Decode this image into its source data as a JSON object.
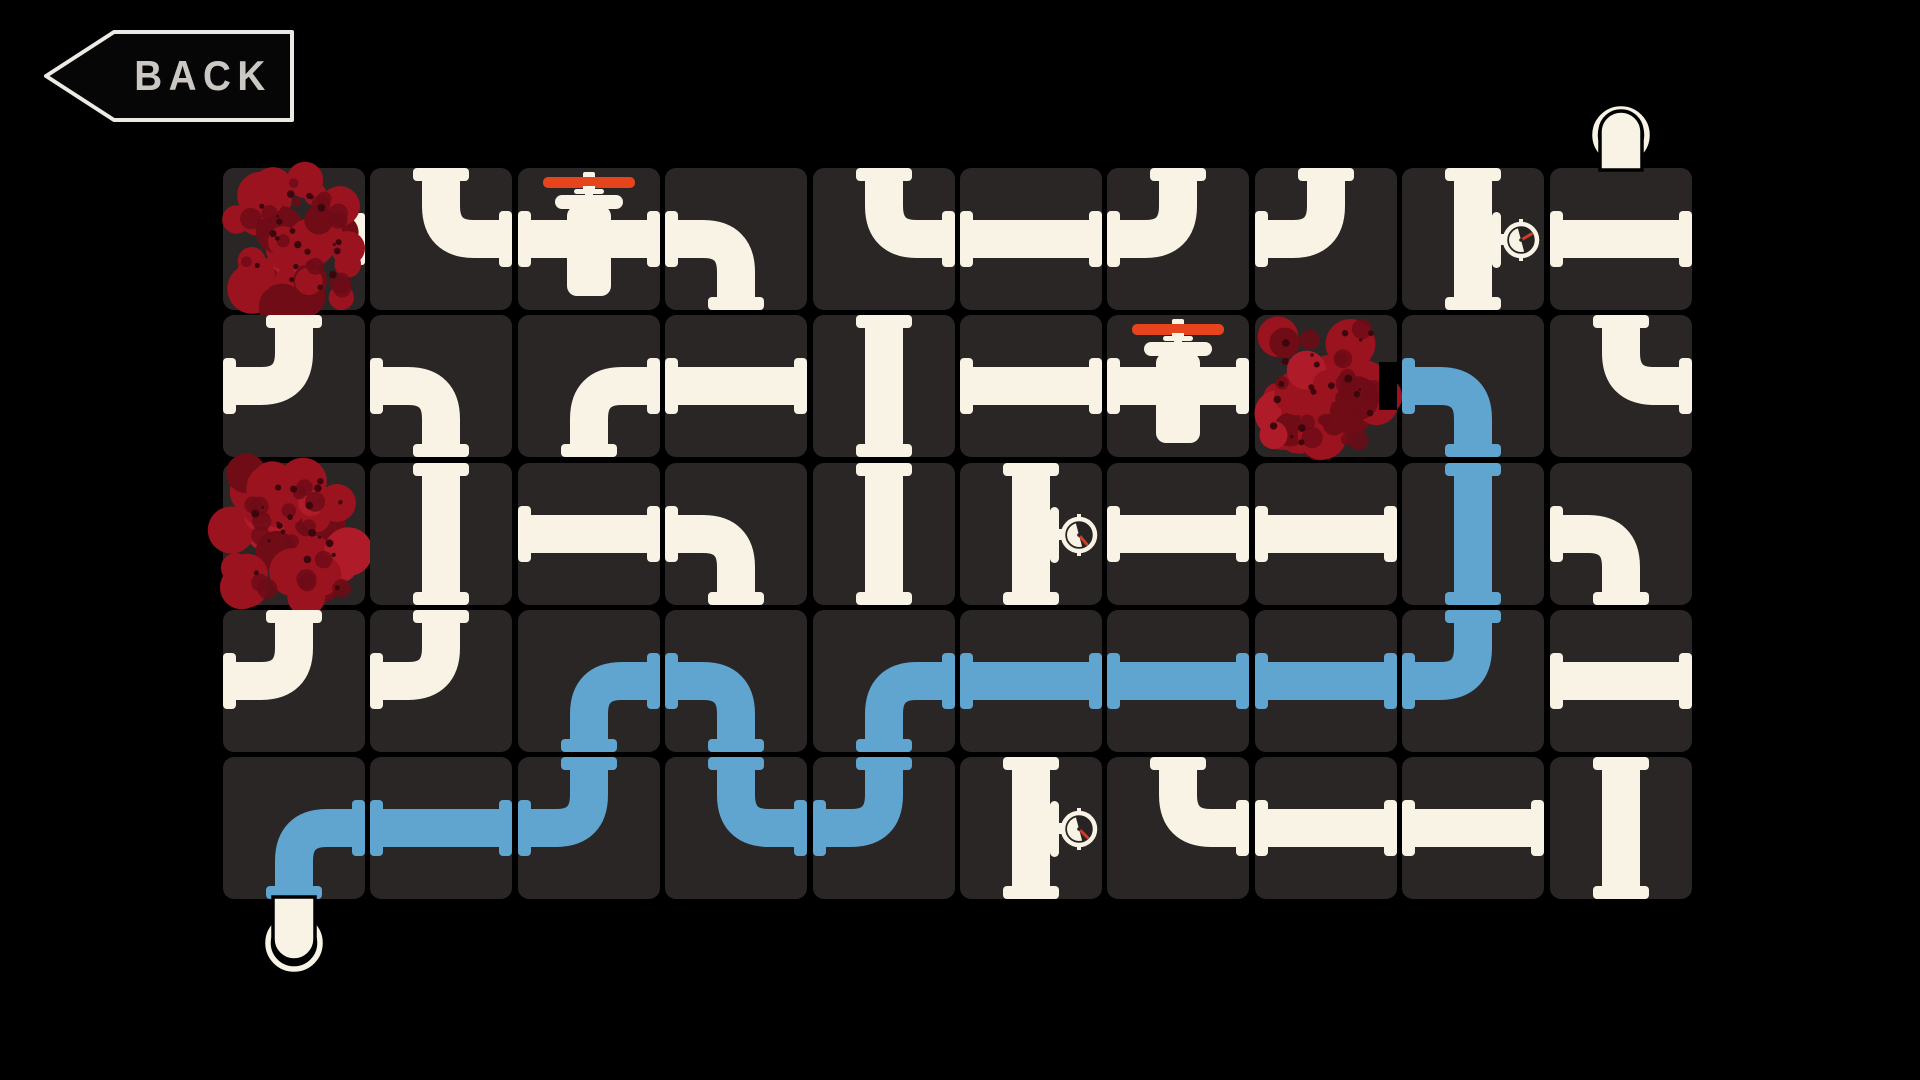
{
  "screen": {
    "width": 1920,
    "height": 1080,
    "description": "pipe connection puzzle game board"
  },
  "colors": {
    "background": "#000000",
    "tile": "#2a2625",
    "tile_gap": "#000000",
    "pipe": "#f8f3e4",
    "water": "#60a5cf",
    "valve_red": "#e5441d",
    "needle_red": "#d23c22",
    "gauge_face": "#262322",
    "blob_base": "#9c1320",
    "blob_dark": "#6f0c16",
    "blob_speck": "#3c060c",
    "blob_bright": "#b01b2a",
    "back_border": "#edeae5",
    "back_text": "#cbc8c3",
    "back_fill": "#060606"
  },
  "back_button": {
    "label": "BACK"
  },
  "board": {
    "rows": 5,
    "cols": 10,
    "origin_x": 223,
    "origin_y": 168,
    "pitch_x": 147.4,
    "pitch_y": 147.25,
    "tile_size": 142,
    "inlet": {
      "attached_col": 10,
      "position": "top"
    },
    "outlet": {
      "attached_col": 1,
      "position": "bottom"
    },
    "water_filled_cells": [
      "r2c9",
      "r3c9",
      "r4c9",
      "r4c8",
      "r4c7",
      "r4c6",
      "r4c5",
      "r5c5",
      "r5c4",
      "r4c4",
      "r4c3",
      "r5c3",
      "r5c2",
      "r5c1"
    ],
    "tiles": [
      {
        "r": 1,
        "c": 1,
        "type": "blob",
        "extra": "stub-right"
      },
      {
        "r": 1,
        "c": 2,
        "type": "pipe",
        "shape": "TR",
        "water": false
      },
      {
        "r": 1,
        "c": 3,
        "type": "valve",
        "shape": "LR",
        "water": false
      },
      {
        "r": 1,
        "c": 4,
        "type": "pipe",
        "shape": "BL",
        "water": false
      },
      {
        "r": 1,
        "c": 5,
        "type": "pipe",
        "shape": "TR",
        "water": false
      },
      {
        "r": 1,
        "c": 6,
        "type": "pipe",
        "shape": "LR",
        "water": false
      },
      {
        "r": 1,
        "c": 7,
        "type": "pipe",
        "shape": "TL",
        "water": false
      },
      {
        "r": 1,
        "c": 8,
        "type": "pipe",
        "shape": "TL",
        "water": false
      },
      {
        "r": 1,
        "c": 9,
        "type": "gauge",
        "shape": "TB",
        "water": false,
        "needle_deg": 60
      },
      {
        "r": 1,
        "c": 10,
        "type": "pipe",
        "shape": "LR",
        "water": false
      },
      {
        "r": 2,
        "c": 1,
        "type": "pipe",
        "shape": "TL",
        "water": false
      },
      {
        "r": 2,
        "c": 2,
        "type": "pipe",
        "shape": "BL",
        "water": false
      },
      {
        "r": 2,
        "c": 3,
        "type": "pipe",
        "shape": "BR",
        "water": false
      },
      {
        "r": 2,
        "c": 4,
        "type": "pipe",
        "shape": "LR",
        "water": false
      },
      {
        "r": 2,
        "c": 5,
        "type": "pipe",
        "shape": "TB",
        "water": false
      },
      {
        "r": 2,
        "c": 6,
        "type": "pipe",
        "shape": "LR",
        "water": false
      },
      {
        "r": 2,
        "c": 7,
        "type": "valve",
        "shape": "LR",
        "water": false
      },
      {
        "r": 2,
        "c": 8,
        "type": "blob",
        "extra": "notch-right"
      },
      {
        "r": 2,
        "c": 9,
        "type": "pipe",
        "shape": "BL",
        "water": true
      },
      {
        "r": 2,
        "c": 10,
        "type": "pipe",
        "shape": "TR",
        "water": false
      },
      {
        "r": 3,
        "c": 1,
        "type": "blob",
        "extra": ""
      },
      {
        "r": 3,
        "c": 2,
        "type": "pipe",
        "shape": "TB",
        "water": false
      },
      {
        "r": 3,
        "c": 3,
        "type": "pipe",
        "shape": "LR",
        "water": false
      },
      {
        "r": 3,
        "c": 4,
        "type": "pipe",
        "shape": "BL",
        "water": false
      },
      {
        "r": 3,
        "c": 5,
        "type": "pipe",
        "shape": "TB",
        "water": false
      },
      {
        "r": 3,
        "c": 6,
        "type": "gauge",
        "shape": "TB",
        "water": false,
        "needle_deg": 140
      },
      {
        "r": 3,
        "c": 7,
        "type": "pipe",
        "shape": "LR",
        "water": false
      },
      {
        "r": 3,
        "c": 8,
        "type": "pipe",
        "shape": "LR",
        "water": false
      },
      {
        "r": 3,
        "c": 9,
        "type": "pipe",
        "shape": "TB",
        "water": true
      },
      {
        "r": 3,
        "c": 10,
        "type": "pipe",
        "shape": "BL",
        "water": false
      },
      {
        "r": 4,
        "c": 1,
        "type": "pipe",
        "shape": "TL",
        "water": false
      },
      {
        "r": 4,
        "c": 2,
        "type": "pipe",
        "shape": "TL",
        "water": false
      },
      {
        "r": 4,
        "c": 3,
        "type": "pipe",
        "shape": "BR",
        "water": true
      },
      {
        "r": 4,
        "c": 4,
        "type": "pipe",
        "shape": "BL",
        "water": true
      },
      {
        "r": 4,
        "c": 5,
        "type": "pipe",
        "shape": "BR",
        "water": true
      },
      {
        "r": 4,
        "c": 6,
        "type": "pipe",
        "shape": "LR",
        "water": true
      },
      {
        "r": 4,
        "c": 7,
        "type": "pipe",
        "shape": "LR",
        "water": true
      },
      {
        "r": 4,
        "c": 8,
        "type": "pipe",
        "shape": "LR",
        "water": true
      },
      {
        "r": 4,
        "c": 9,
        "type": "pipe",
        "shape": "TL",
        "water": true
      },
      {
        "r": 4,
        "c": 10,
        "type": "pipe",
        "shape": "LR",
        "water": false
      },
      {
        "r": 5,
        "c": 1,
        "type": "pipe",
        "shape": "BR",
        "water": true
      },
      {
        "r": 5,
        "c": 2,
        "type": "pipe",
        "shape": "LR",
        "water": true
      },
      {
        "r": 5,
        "c": 3,
        "type": "pipe",
        "shape": "TL",
        "water": true
      },
      {
        "r": 5,
        "c": 4,
        "type": "pipe",
        "shape": "TR",
        "water": true
      },
      {
        "r": 5,
        "c": 5,
        "type": "pipe",
        "shape": "TL",
        "water": true
      },
      {
        "r": 5,
        "c": 6,
        "type": "gauge",
        "shape": "TB",
        "water": false,
        "needle_deg": 135
      },
      {
        "r": 5,
        "c": 7,
        "type": "pipe",
        "shape": "TR",
        "water": false
      },
      {
        "r": 5,
        "c": 8,
        "type": "pipe",
        "shape": "LR",
        "water": false
      },
      {
        "r": 5,
        "c": 9,
        "type": "pipe",
        "shape": "LR",
        "water": false
      },
      {
        "r": 5,
        "c": 10,
        "type": "pipe",
        "shape": "TB",
        "water": false
      }
    ]
  }
}
